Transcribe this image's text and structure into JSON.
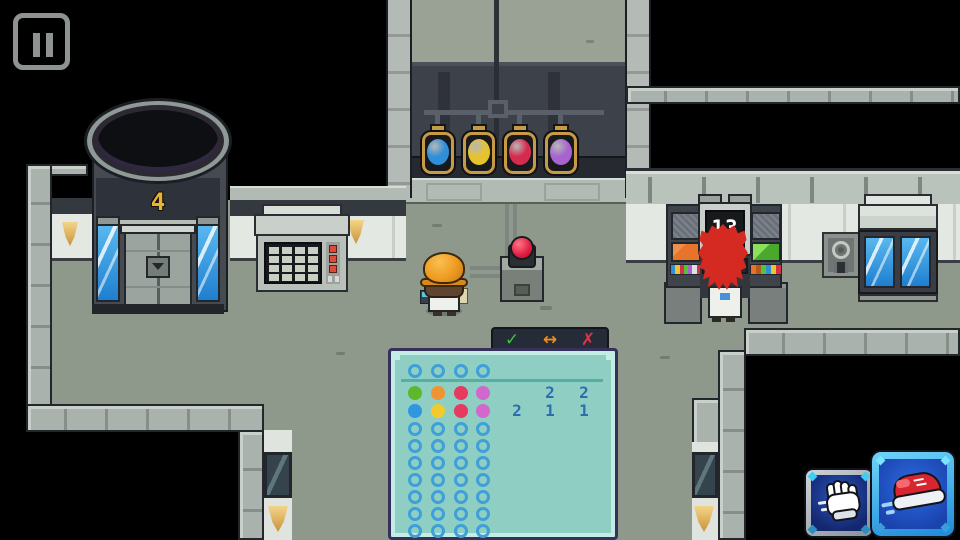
{
  "hud": {
    "pause_button": {
      "icon": "pause"
    },
    "action_buttons": [
      {
        "id": "walk",
        "icon": "glove-hand",
        "selected": false
      },
      {
        "id": "run",
        "icon": "sneaker",
        "selected": true
      }
    ]
  },
  "room": {
    "elevator": {
      "floor_label": "4"
    },
    "counter_machine": {
      "display_value": "13",
      "left_strip_colors": [
        "#2f8fd8",
        "#e8c82e",
        "#d83048",
        "#58c238",
        "#a763cf",
        "#e0e0e0",
        "#d83048"
      ],
      "right_strip_colors": [
        "#e8742c",
        "#b85a1c",
        "#58c238",
        "#2f8fd8",
        "#e8c82e",
        "#d83048"
      ]
    },
    "keypad_machine": {
      "key_rows": 4,
      "key_cols": 4
    },
    "wall_orbs": {
      "colors": [
        "#2f8fd8",
        "#e6c32e",
        "#d62a4e",
        "#a763cf"
      ]
    }
  },
  "puzzle": {
    "header_actions": [
      {
        "id": "confirm",
        "glyph": "✓",
        "color": "#3ec63e"
      },
      {
        "id": "swap",
        "glyph": "↔",
        "color": "#f08c1e"
      },
      {
        "id": "cancel",
        "glyph": "✗",
        "color": "#e23545"
      }
    ],
    "board": {
      "palette_row": [
        "empty",
        "empty",
        "empty",
        "empty"
      ],
      "clue_rows": [
        {
          "dots": [
            "green",
            "orange",
            "red",
            "pink"
          ],
          "numbers": [
            "",
            "2",
            "2"
          ]
        },
        {
          "dots": [
            "blue",
            "yellow",
            "red",
            "pink"
          ],
          "numbers": [
            "2",
            "1",
            "1"
          ]
        }
      ],
      "empty_rows": 7,
      "columns": 4,
      "dot_colors": {
        "green": "#5cb82c",
        "orange": "#f09433",
        "red": "#e63a5e",
        "pink": "#d268cc",
        "blue": "#2f97e0",
        "yellow": "#f2ca2e"
      },
      "ring_color": "#3f9fd8",
      "number_color": "#2e6cb0",
      "board_color": "#8fcfc3"
    }
  }
}
